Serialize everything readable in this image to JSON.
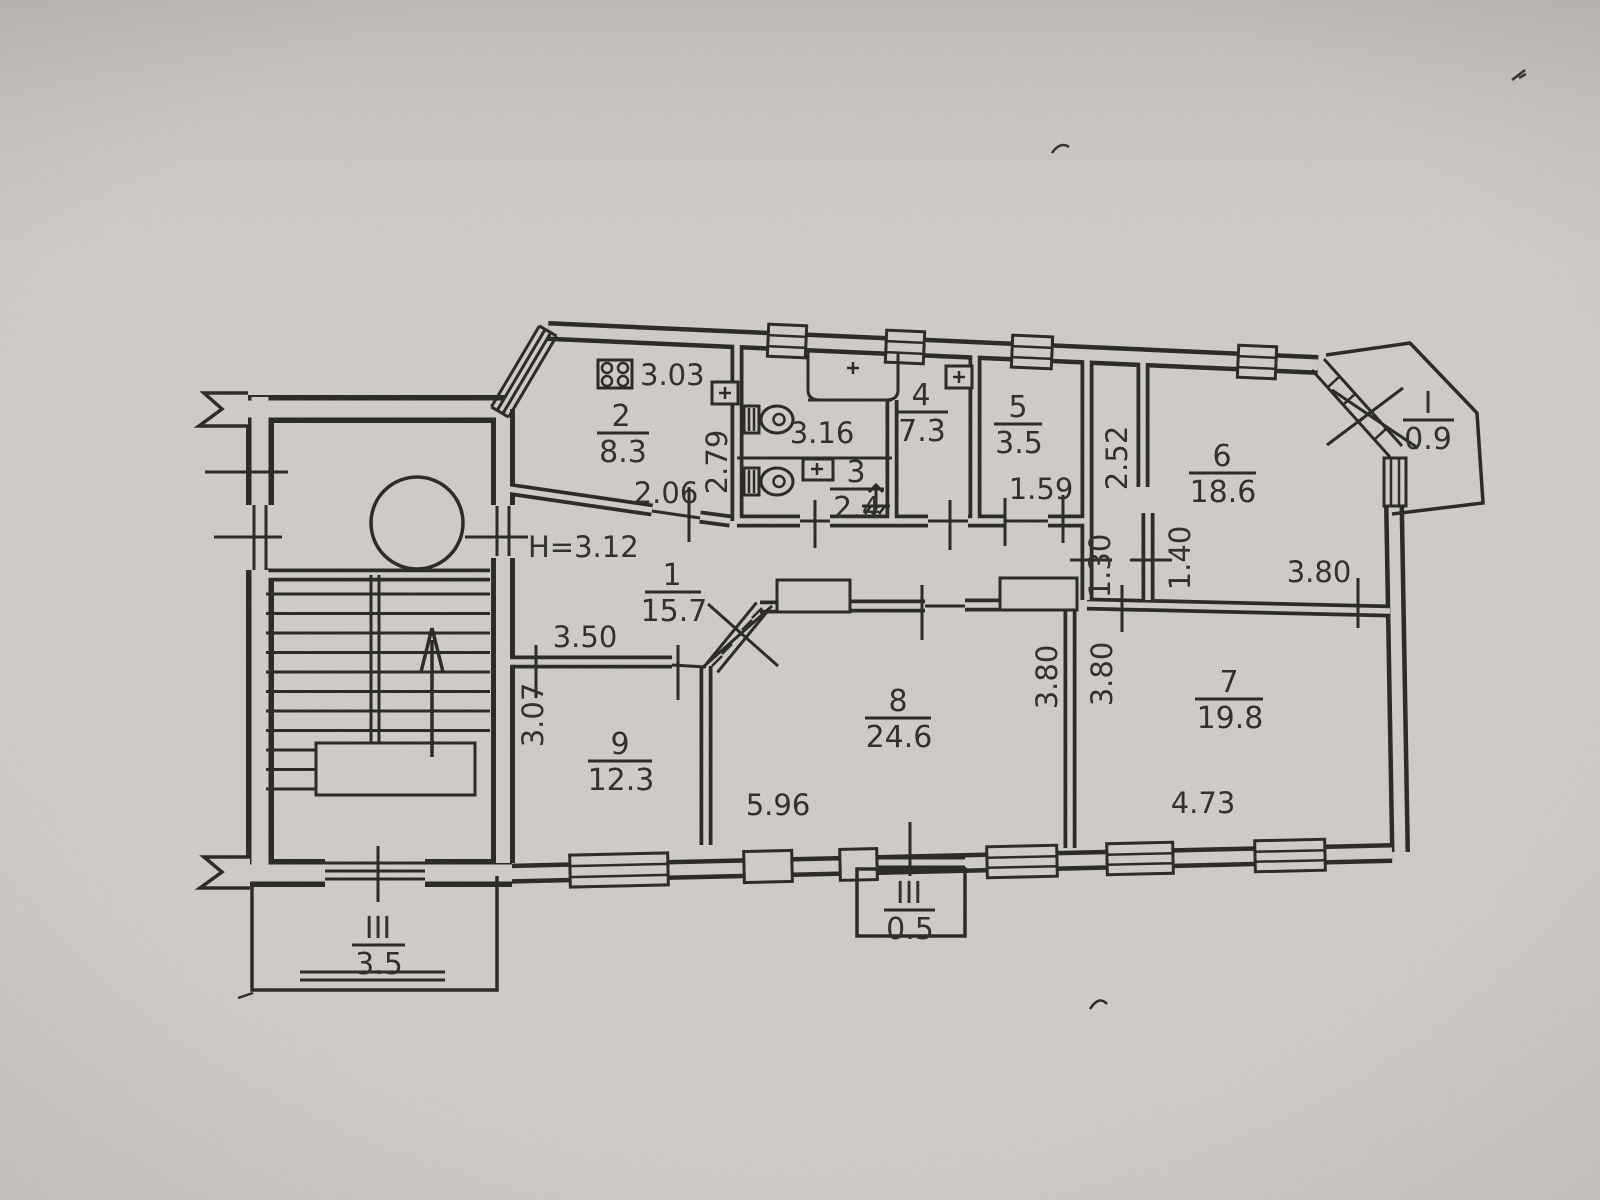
{
  "scan": {
    "paper_color": "#d2cfc9",
    "ink_color": "#1d1c1a"
  },
  "plan": {
    "height_note": "H=3.12",
    "rooms": {
      "r1": {
        "number": "1",
        "area": "15.7"
      },
      "r2": {
        "number": "2",
        "area": "8.3"
      },
      "r3": {
        "number": "3",
        "area": "2.4"
      },
      "r4": {
        "number": "4",
        "area": "7.3"
      },
      "r5": {
        "number": "5",
        "area": "3.5"
      },
      "r6": {
        "number": "6",
        "area": "18.6"
      },
      "r7": {
        "number": "7",
        "area": "19.8"
      },
      "r8": {
        "number": "8",
        "area": "24.6"
      },
      "r9": {
        "number": "9",
        "area": "12.3"
      }
    },
    "balconies": {
      "top_right": {
        "number": "I",
        "area": "0.9"
      },
      "bottom_center": {
        "number": "III",
        "area": "0.5"
      },
      "bottom_left": {
        "number": "III",
        "area": "3.5"
      }
    },
    "dims": {
      "stove": "3.03",
      "w206": "2.06",
      "w279": "2.79",
      "w316": "3.16",
      "w159": "1.59",
      "w252": "2.52",
      "w130": "1.30",
      "w140": "1.40",
      "w380_top": "3.80",
      "w350": "3.50",
      "w307": "3.07",
      "w380_left": "3.80",
      "w380_right": "3.80",
      "w596": "5.96",
      "w473": "4.73"
    }
  }
}
